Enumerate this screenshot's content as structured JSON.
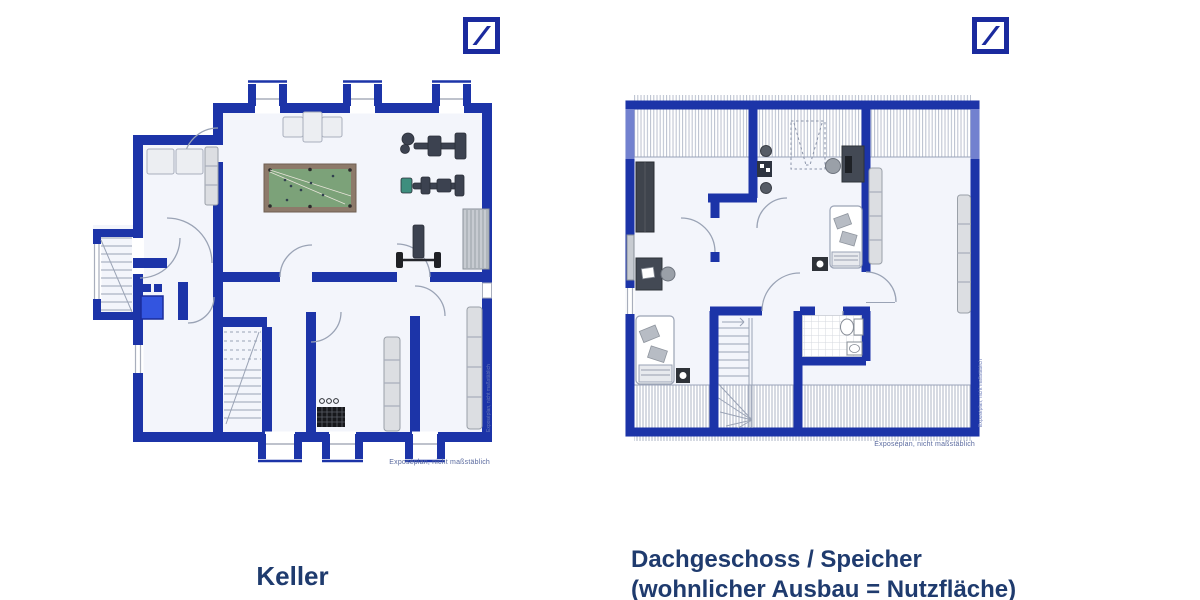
{
  "colors": {
    "wall_blue": "#1C34A8",
    "logo_navy": "#1A2A9E",
    "caption_navy": "#1F3B6E",
    "floor_fill": "#F3F5FB",
    "felt_green": "#7CA279",
    "frame_brown": "#8D7A6A",
    "sink_blue": "#3355E0",
    "hatch_gray": "#B9BFCE",
    "disclaimer_blue": "#5A6A9F"
  },
  "logos": {
    "left": {
      "icon": "deutsche-bank-logo"
    },
    "right": {
      "icon": "deutsche-bank-logo"
    }
  },
  "plans": {
    "keller": {
      "caption": "Keller",
      "disclaimer": "Exposéplan, nicht maßstäblich",
      "side_watermark": "Exposéplan, nicht maßstäblich"
    },
    "dachgeschoss": {
      "caption_line1": "Dachgeschoss / Speicher",
      "caption_line2": "(wohnlicher Ausbau = Nutzfläche)",
      "disclaimer": "Exposéplan, nicht maßstäblich",
      "side_watermark": "Exposéplan, nicht maßstäblich"
    }
  }
}
